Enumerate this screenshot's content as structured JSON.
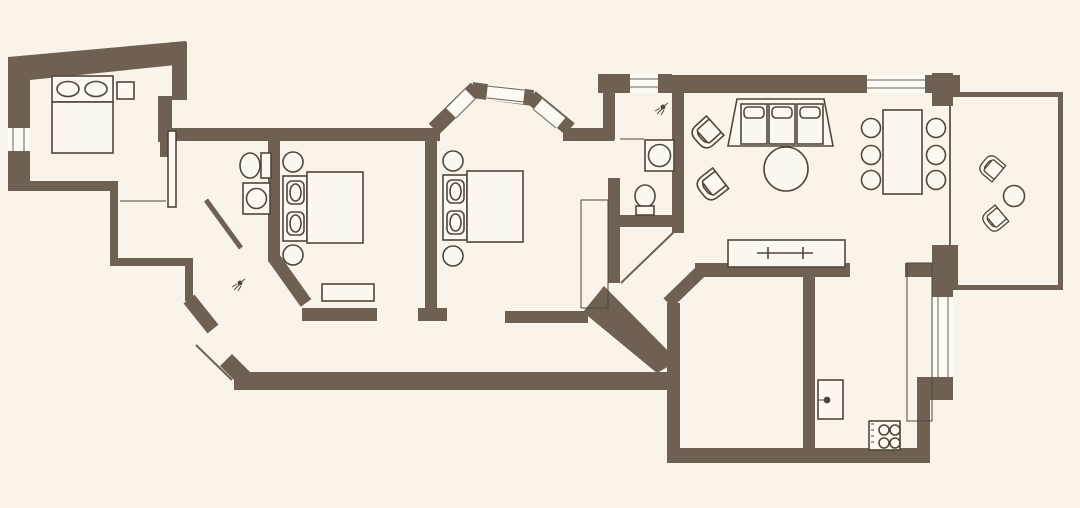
{
  "meta": {
    "title": "apartment-floor-plan",
    "canvas": {
      "width": 1080,
      "height": 508
    }
  },
  "palette": {
    "background": "#f9f3e9",
    "wall": "#6e6052",
    "furniture_line": "#4f473c",
    "furniture_fill": "#fcf8f0",
    "window_fill": "#fdfaf3"
  },
  "rooms": [
    {
      "name": "bedroom-1",
      "position": "top-left",
      "furniture": [
        "double-bed",
        "two-pillows",
        "nightstand"
      ],
      "windows": 1,
      "doors": 1
    },
    {
      "name": "hallway-closet",
      "position": "left-of-bathroom-1",
      "furniture": [
        "shelf-line"
      ],
      "windows": 0,
      "doors": 1
    },
    {
      "name": "bathroom-1",
      "position": "left-center",
      "furniture": [
        "toilet",
        "washbasin",
        "shower-partition",
        "shower-head"
      ],
      "windows": 0,
      "doors": 1
    },
    {
      "name": "bedroom-2",
      "position": "center-left",
      "furniture": [
        "double-bed",
        "stool",
        "stool",
        "bench-rug"
      ],
      "windows": 0,
      "doors": 1
    },
    {
      "name": "bedroom-3",
      "position": "center",
      "bay_window_panes": 3,
      "furniture": [
        "double-bed",
        "stool",
        "stool",
        "wardrobe"
      ],
      "windows": 3,
      "doors": 1
    },
    {
      "name": "bathroom-2",
      "position": "center-right",
      "furniture": [
        "washing-machine",
        "toilet",
        "shower-head",
        "shower-glass"
      ],
      "windows": 1,
      "doors": 1
    },
    {
      "name": "living-dining-room",
      "position": "right",
      "furniture": [
        "armchair",
        "armchair",
        "sofa-3-seat",
        "coffee-table-round",
        "dining-table",
        "dining-chair",
        "dining-chair",
        "dining-chair",
        "dining-chair",
        "dining-chair",
        "dining-chair",
        "sideboard-tv"
      ],
      "windows": 2,
      "doors": 2
    },
    {
      "name": "balcony",
      "position": "far-right",
      "furniture": [
        "chair",
        "chair",
        "table-round"
      ],
      "windows": 0,
      "doors": 1
    },
    {
      "name": "kitchen",
      "position": "bottom-right",
      "furniture": [
        "counter",
        "sink-unit",
        "stove-4-burner"
      ],
      "windows": 1,
      "doors": 1
    },
    {
      "name": "entry-corridor",
      "position": "bottom",
      "furniture": [],
      "windows": 0,
      "doors": 1
    }
  ],
  "counts": {
    "bedrooms": 3,
    "bathrooms": 2,
    "dining_chairs": 6,
    "balcony_chairs": 2
  }
}
